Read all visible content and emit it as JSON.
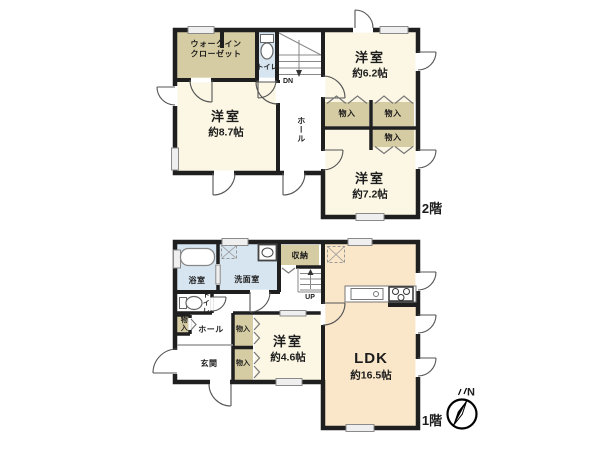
{
  "floor2": {
    "floor_label": "2階",
    "walk_in_closet": {
      "line1": "ウォークイン",
      "line2": "クローゼット"
    },
    "toilet": "トイレ",
    "stairs_label": "DN",
    "hall": "ホール",
    "room_62": {
      "name": "洋室",
      "area": "約6.2帖"
    },
    "room_87": {
      "name": "洋室",
      "area": "約8.7帖"
    },
    "room_72": {
      "name": "洋室",
      "area": "約7.2帖"
    },
    "storage_a": "物入",
    "storage_b": "物入",
    "storage_c": "物入"
  },
  "floor1": {
    "floor_label": "1階",
    "bathroom": "浴室",
    "washroom": "洗面室",
    "storage": "収納",
    "stairs_label": "UP",
    "toilet": "トイレ",
    "hall": "ホール",
    "entrance": "玄関",
    "storage_small": "物入",
    "storage_a": "物入",
    "storage_b": "物入",
    "room_46": {
      "name": "洋室",
      "area": "約4.6帖"
    },
    "ldk": {
      "name": "LDK",
      "area": "約16.5帖"
    }
  },
  "compass": {
    "north": "N"
  },
  "colors": {
    "wall": "#1f1f1f",
    "room_cream": "#FBF7E4",
    "storage_beige": "#D6CCA3",
    "water_blue": "#D7E5F0",
    "ldk_peach": "#FAE7CA"
  }
}
